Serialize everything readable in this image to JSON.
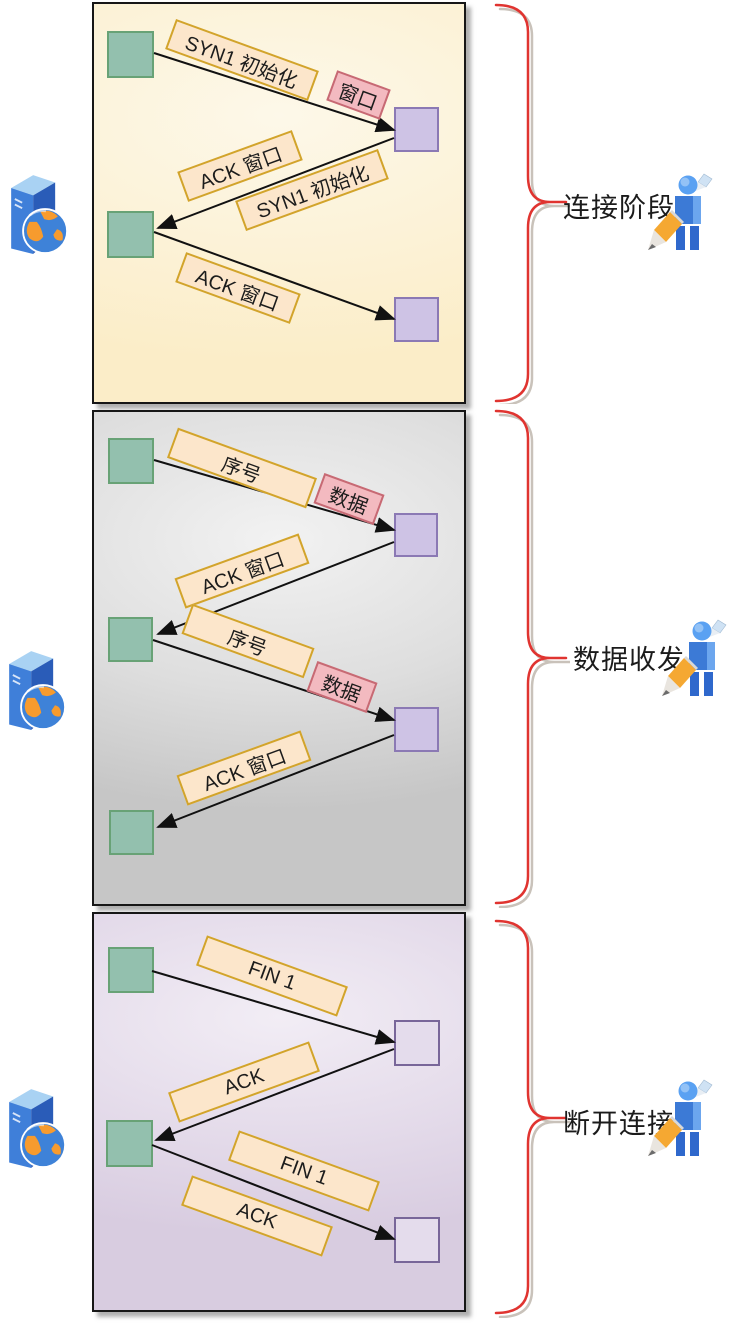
{
  "diagram": {
    "type": "tcp-communication-flow",
    "colors": {
      "panel1_bg": "#fbeecb",
      "panel2_bg": "#c9c9c9",
      "panel3_bg": "#d9cde1",
      "label_cream_bg": "#fce6cb",
      "label_cream_border": "#d2a42b",
      "label_pink_bg": "#f3bac0",
      "label_pink_border": "#c76a74",
      "square_green": "#93c0ae",
      "square_green_border": "#68a276",
      "square_purple": "#cec3e5",
      "square_purple_border": "#8b79b4",
      "brace_red": "#e03430",
      "arrow_color": "#111111"
    }
  },
  "panels": [
    {
      "name": "connection-phase",
      "label": "连接阶段",
      "messages": [
        {
          "text": "SYN1 初始化",
          "style": "cream"
        },
        {
          "text": "窗口",
          "style": "pink"
        },
        {
          "text": "ACK 窗口",
          "style": "cream"
        },
        {
          "text": "SYN1 初始化",
          "style": "cream"
        },
        {
          "text": "ACK 窗口",
          "style": "cream"
        }
      ]
    },
    {
      "name": "data-transfer",
      "label": "数据收发",
      "messages": [
        {
          "text": "序号",
          "style": "cream"
        },
        {
          "text": "数据",
          "style": "pink"
        },
        {
          "text": "ACK 窗口",
          "style": "cream"
        },
        {
          "text": "序号",
          "style": "cream"
        },
        {
          "text": "数据",
          "style": "pink"
        },
        {
          "text": "ACK 窗口",
          "style": "cream"
        }
      ]
    },
    {
      "name": "disconnect",
      "label": "断开连接",
      "messages": [
        {
          "text": "FIN 1",
          "style": "cream"
        },
        {
          "text": "ACK",
          "style": "cream"
        },
        {
          "text": "FIN 1",
          "style": "cream"
        },
        {
          "text": "ACK",
          "style": "cream"
        }
      ]
    }
  ]
}
